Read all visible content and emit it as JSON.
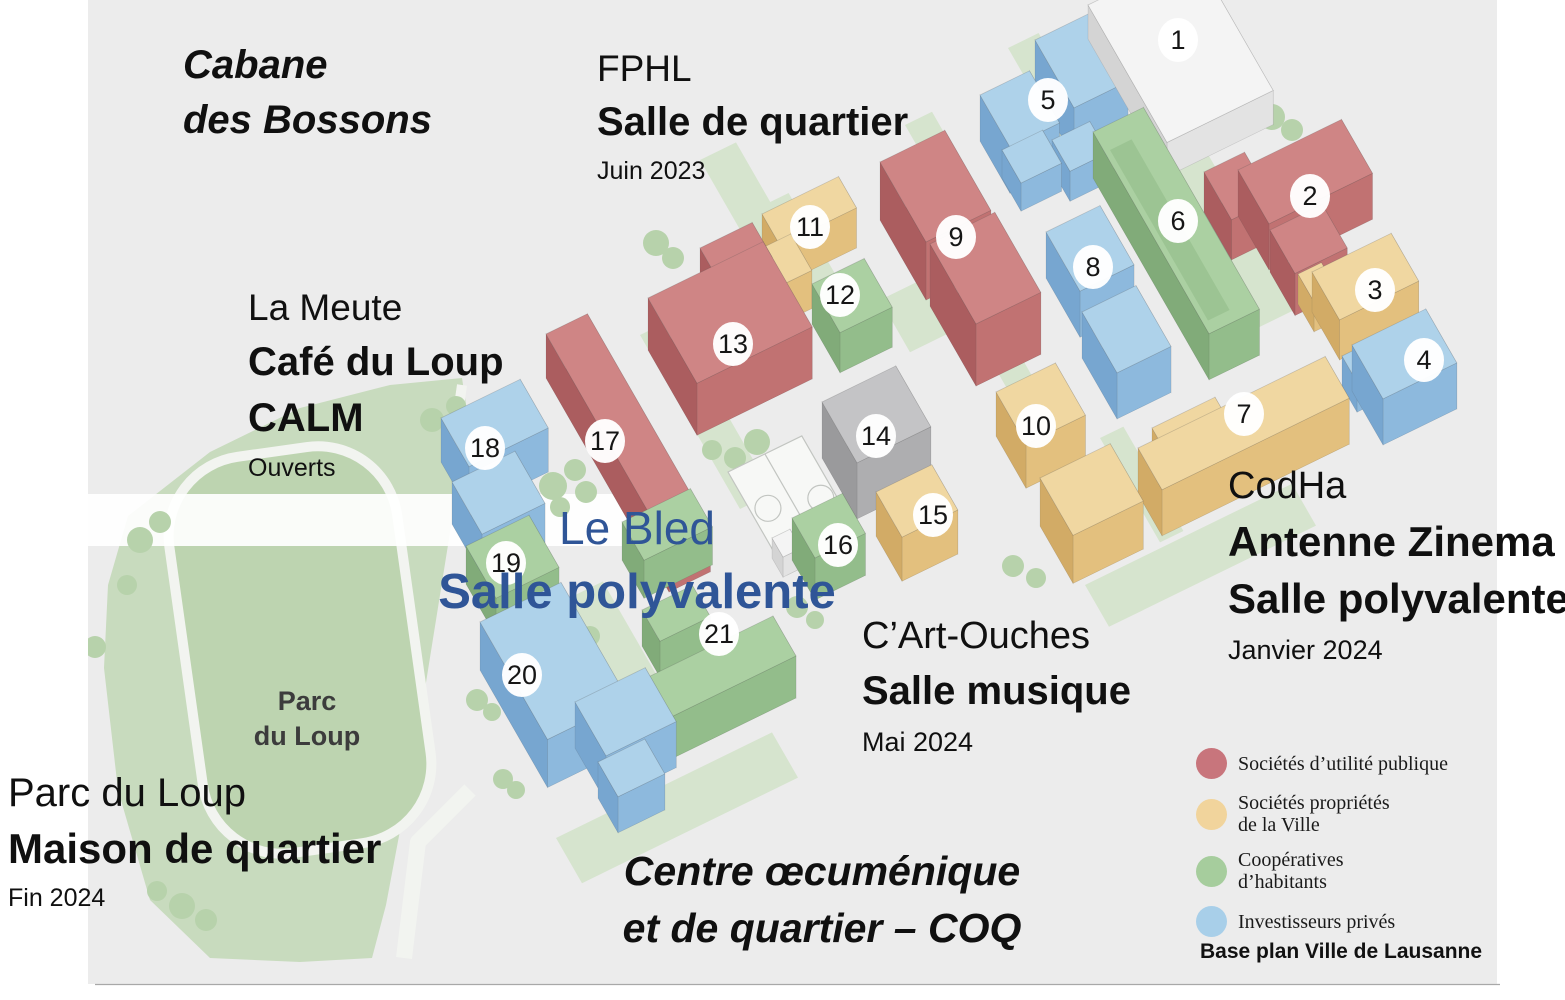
{
  "annotations": {
    "cabane": {
      "line1": "Cabane",
      "line2": "des Bossons"
    },
    "fphl": {
      "name": "FPHL",
      "facility": "Salle de quartier",
      "date": "Juin 2023"
    },
    "lameute": {
      "name": "La Meute",
      "facility1": "Café du Loup",
      "facility2": "CALM",
      "status": "Ouverts"
    },
    "lebled": {
      "name": "Le Bled",
      "facility": "Salle polyvalente"
    },
    "codha": {
      "name": "CodHa",
      "facility1": "Antenne Zinema",
      "facility2": "Salle polyvalente",
      "date": "Janvier 2024"
    },
    "cartouches": {
      "name": "C’Art-Ouches",
      "facility": "Salle musique",
      "date": "Mai 2024"
    },
    "parcduloup": {
      "name": "Parc du Loup",
      "facility": "Maison de quartier",
      "date": "Fin 2024"
    },
    "coq": {
      "line1": "Centre œcuménique",
      "line2": "et de quartier – COQ"
    },
    "park_label": {
      "line1": "Parc",
      "line2": "du Loup"
    }
  },
  "legend": {
    "items": [
      {
        "id": "pub",
        "color": "#c8757c",
        "l1": "Sociétés d’utilité publique",
        "l2": ""
      },
      {
        "id": "ville",
        "color": "#f1d49c",
        "l1": "Sociétés propriétés",
        "l2": "de la Ville"
      },
      {
        "id": "coop",
        "color": "#a6cd9d",
        "l1": "Coopératives",
        "l2": "d’habitants"
      },
      {
        "id": "priv",
        "color": "#a8cfe9",
        "l1": "Investisseurs privés",
        "l2": ""
      }
    ],
    "note": "Base plan Ville de Lausanne"
  },
  "map": {
    "bg": "#ececec",
    "accent_blue": "#2f5597",
    "categories": {
      "pub": {
        "top": "#cf8585",
        "mid": "#c17272",
        "dark": "#ab5d5f"
      },
      "ville": {
        "top": "#f0d7a1",
        "mid": "#e3c07e",
        "dark": "#d2ab66"
      },
      "coop": {
        "top": "#abd0a2",
        "mid": "#93bd8b",
        "dark": "#81ab79"
      },
      "priv": {
        "top": "#aed2ea",
        "mid": "#8db9dd",
        "dark": "#77a6d0"
      },
      "eq": {
        "top": "#c4c4c6",
        "mid": "#aeaeb0",
        "dark": "#9a9a9c"
      },
      "wht": {
        "top": "#f4f4f4",
        "mid": "#e3e3e3",
        "dark": "#d4d4d4"
      }
    },
    "buildings": [
      {
        "n": 1,
        "cat": "wht",
        "marker": [
          1178,
          40
        ],
        "parts": [
          [
            1088,
            5,
            118,
            158,
            34
          ]
        ]
      },
      {
        "n": 2,
        "cat": "pub",
        "marker": [
          1310,
          196
        ],
        "parts": [
          [
            1238,
            170,
            115,
            62,
            46
          ],
          [
            1204,
            172,
            45,
            55,
            40
          ],
          [
            1270,
            230,
            58,
            50,
            42
          ]
        ]
      },
      {
        "n": 3,
        "cat": "ville",
        "marker": [
          1375,
          290
        ],
        "parts": [
          [
            1312,
            272,
            88,
            55,
            40
          ],
          [
            1298,
            274,
            26,
            32,
            30
          ]
        ]
      },
      {
        "n": 4,
        "cat": "priv",
        "marker": [
          1424,
          360
        ],
        "parts": [
          [
            1352,
            345,
            82,
            62,
            46
          ],
          [
            1342,
            356,
            24,
            30,
            30
          ]
        ]
      },
      {
        "n": 5,
        "cat": "priv",
        "marker": [
          1048,
          100
        ],
        "parts": [
          [
            1035,
            40,
            60,
            78,
            50
          ],
          [
            980,
            95,
            55,
            60,
            46
          ],
          [
            1002,
            150,
            45,
            38,
            28
          ],
          [
            1052,
            140,
            42,
            36,
            30
          ]
        ]
      },
      {
        "n": 6,
        "cat": "coop",
        "marker": [
          1178,
          221
        ],
        "parts": [
          [
            1093,
            132,
            56,
            232,
            46
          ]
        ]
      },
      {
        "n": 7,
        "cat": "ville",
        "marker": [
          1244,
          414
        ],
        "parts": [
          [
            1138,
            448,
            208,
            48,
            46
          ],
          [
            1152,
            428,
            70,
            22,
            36
          ]
        ]
      },
      {
        "n": 8,
        "cat": "priv",
        "marker": [
          1093,
          267
        ],
        "parts": [
          [
            1046,
            232,
            60,
            68,
            46
          ],
          [
            1082,
            312,
            60,
            70,
            46
          ]
        ]
      },
      {
        "n": 9,
        "cat": "pub",
        "marker": [
          956,
          237
        ],
        "parts": [
          [
            880,
            162,
            72,
            92,
            58
          ],
          [
            930,
            244,
            72,
            92,
            62
          ]
        ]
      },
      {
        "n": 10,
        "cat": "ville",
        "marker": [
          1036,
          426
        ],
        "parts": [
          [
            996,
            392,
            66,
            60,
            44
          ],
          [
            1040,
            478,
            78,
            66,
            48
          ]
        ]
      },
      {
        "n": 11,
        "cat": "ville",
        "marker": [
          810,
          227
        ],
        "parts": [
          [
            762,
            214,
            85,
            36,
            40
          ],
          [
            762,
            248,
            32,
            42,
            38
          ]
        ]
      },
      {
        "n": 12,
        "cat": "coop",
        "marker": [
          840,
          295
        ],
        "parts": [
          [
            812,
            284,
            58,
            56,
            40
          ]
        ]
      },
      {
        "n": 13,
        "cat": "pub",
        "marker": [
          733,
          344
        ],
        "parts": [
          [
            648,
            298,
            128,
            98,
            52
          ],
          [
            700,
            248,
            58,
            40,
            48
          ]
        ]
      },
      {
        "n": 14,
        "cat": "eq",
        "marker": [
          876,
          436
        ],
        "parts": [
          [
            822,
            402,
            82,
            70,
            56
          ]
        ]
      },
      {
        "n": 15,
        "cat": "ville",
        "marker": [
          933,
          515
        ],
        "parts": [
          [
            876,
            492,
            62,
            52,
            44
          ]
        ]
      },
      {
        "n": 16,
        "cat": "coop",
        "marker": [
          838,
          545
        ],
        "parts": [
          [
            792,
            518,
            56,
            46,
            42
          ]
        ]
      },
      {
        "n": 17,
        "cat": "pub",
        "marker": [
          605,
          441
        ],
        "parts": [
          [
            546,
            334,
            46,
            246,
            44
          ]
        ]
      },
      {
        "n": 18,
        "cat": "priv",
        "marker": [
          485,
          448
        ],
        "parts": [
          [
            441,
            418,
            88,
            56,
            44
          ],
          [
            452,
            482,
            70,
            60,
            42
          ]
        ]
      },
      {
        "n": 19,
        "cat": "coop",
        "marker": [
          506,
          563
        ],
        "parts": [
          [
            466,
            546,
            70,
            60,
            38
          ]
        ]
      },
      {
        "n": 20,
        "cat": "priv",
        "marker": [
          522,
          675
        ],
        "parts": [
          [
            480,
            622,
            90,
            135,
            48
          ],
          [
            575,
            702,
            78,
            62,
            46
          ],
          [
            598,
            762,
            52,
            40,
            36
          ]
        ]
      },
      {
        "n": 21,
        "cat": "coop",
        "marker": [
          719,
          634
        ],
        "parts": [
          [
            638,
            682,
            150,
            46,
            42
          ],
          [
            642,
            610,
            56,
            36,
            36
          ],
          [
            622,
            522,
            76,
            44,
            38
          ]
        ]
      }
    ],
    "extras": [
      {
        "cat": "wht",
        "parts": [
          [
            772,
            538,
            20,
            22,
            20
          ]
        ]
      }
    ],
    "roof_details": [
      {
        "x": 1110,
        "y": 150,
        "lu": 24,
        "lv": 196,
        "c": "#8fb987"
      }
    ],
    "greens": [
      [
        1008,
        48,
        34,
        150
      ],
      [
        905,
        125,
        30,
        160
      ],
      [
        758,
        208,
        34,
        150
      ],
      [
        1164,
        162,
        42,
        190
      ],
      [
        986,
        352,
        28,
        170
      ],
      [
        640,
        335,
        36,
        200
      ],
      [
        1085,
        585,
        230,
        48
      ],
      [
        556,
        838,
        240,
        52
      ],
      [
        880,
        300,
        60,
        60
      ],
      [
        700,
        160,
        40,
        130
      ],
      [
        752,
        478,
        40,
        48
      ],
      [
        565,
        600,
        42,
        120
      ],
      [
        1100,
        438,
        26,
        120
      ]
    ],
    "trees": [
      [
        656,
        243,
        13
      ],
      [
        673,
        258,
        11
      ],
      [
        757,
        442,
        13
      ],
      [
        735,
        458,
        11
      ],
      [
        712,
        450,
        10
      ],
      [
        646,
        498,
        12
      ],
      [
        664,
        514,
        10
      ],
      [
        553,
        486,
        14
      ],
      [
        575,
        470,
        11
      ],
      [
        560,
        507,
        10
      ],
      [
        586,
        492,
        11
      ],
      [
        570,
        623,
        12
      ],
      [
        590,
        636,
        10
      ],
      [
        477,
        700,
        11
      ],
      [
        492,
        712,
        9
      ],
      [
        503,
        779,
        10
      ],
      [
        516,
        790,
        9
      ],
      [
        797,
        607,
        11
      ],
      [
        815,
        620,
        9
      ],
      [
        1013,
        566,
        11
      ],
      [
        1036,
        578,
        10
      ],
      [
        1188,
        152,
        12
      ],
      [
        1272,
        117,
        13
      ],
      [
        1292,
        130,
        11
      ],
      [
        1257,
        218,
        11
      ],
      [
        140,
        540,
        13
      ],
      [
        160,
        522,
        11
      ],
      [
        127,
        585,
        10
      ],
      [
        432,
        420,
        12
      ],
      [
        456,
        406,
        10
      ],
      [
        182,
        906,
        13
      ],
      [
        206,
        920,
        11
      ],
      [
        157,
        891,
        10
      ],
      [
        95,
        647,
        11
      ]
    ],
    "courts": {
      "x": 728,
      "y": 472,
      "lu": 82,
      "lv": 118
    },
    "park": {
      "fill": "#c8dbbe",
      "lawn_fill": "#bdd4b0",
      "path": "#f2f4f0",
      "outline": [
        [
          128,
          516
        ],
        [
          210,
          452
        ],
        [
          300,
          408
        ],
        [
          390,
          385
        ],
        [
          462,
          378
        ],
        [
          470,
          430
        ],
        [
          452,
          520
        ],
        [
          436,
          620
        ],
        [
          420,
          720
        ],
        [
          402,
          820
        ],
        [
          386,
          905
        ],
        [
          372,
          958
        ],
        [
          300,
          962
        ],
        [
          210,
          958
        ],
        [
          150,
          900
        ],
        [
          118,
          790
        ],
        [
          104,
          668
        ],
        [
          108,
          585
        ]
      ]
    },
    "green_flat": "#d6e4ce",
    "tree_fill": "#b7d2ab"
  }
}
